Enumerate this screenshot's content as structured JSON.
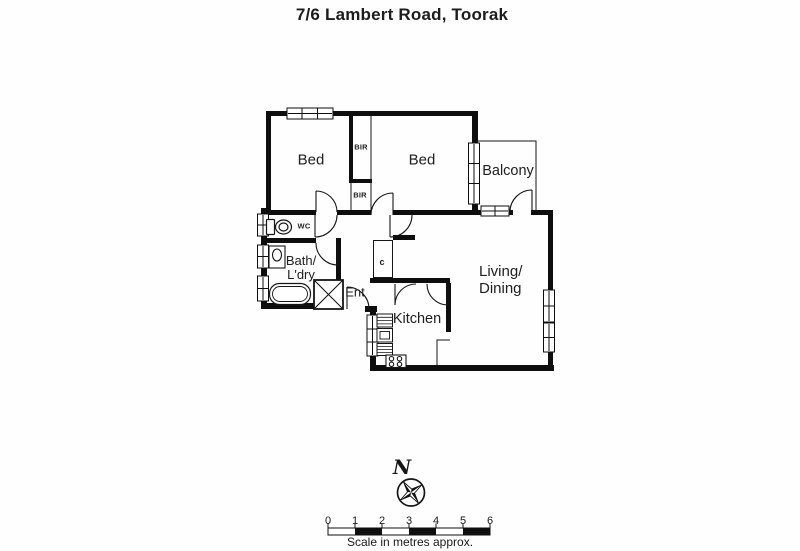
{
  "title": "7/6 Lambert Road, Toorak",
  "colors": {
    "wall": "#0e0e0e",
    "line": "#161616",
    "background": "#fdfefd",
    "text": "#1d1d1d"
  },
  "floorplan": {
    "rooms": {
      "bed1": "Bed",
      "bed2": "Bed",
      "balcony": "Balcony",
      "living_dining": {
        "line1": "Living/",
        "line2": "Dining"
      },
      "kitchen": "Kitchen",
      "bath_laundry": {
        "line1": "Bath/",
        "line2": "L'dry"
      },
      "entry": "Ent",
      "wc": "WC",
      "cupboard": "c",
      "built_in_robes": [
        "BIR",
        "BIR"
      ]
    }
  },
  "compass": {
    "north": "N"
  },
  "scale_bar": {
    "tick_labels": [
      "0",
      "1",
      "2",
      "3",
      "4",
      "5",
      "6"
    ],
    "caption": "Scale in metres approx."
  }
}
